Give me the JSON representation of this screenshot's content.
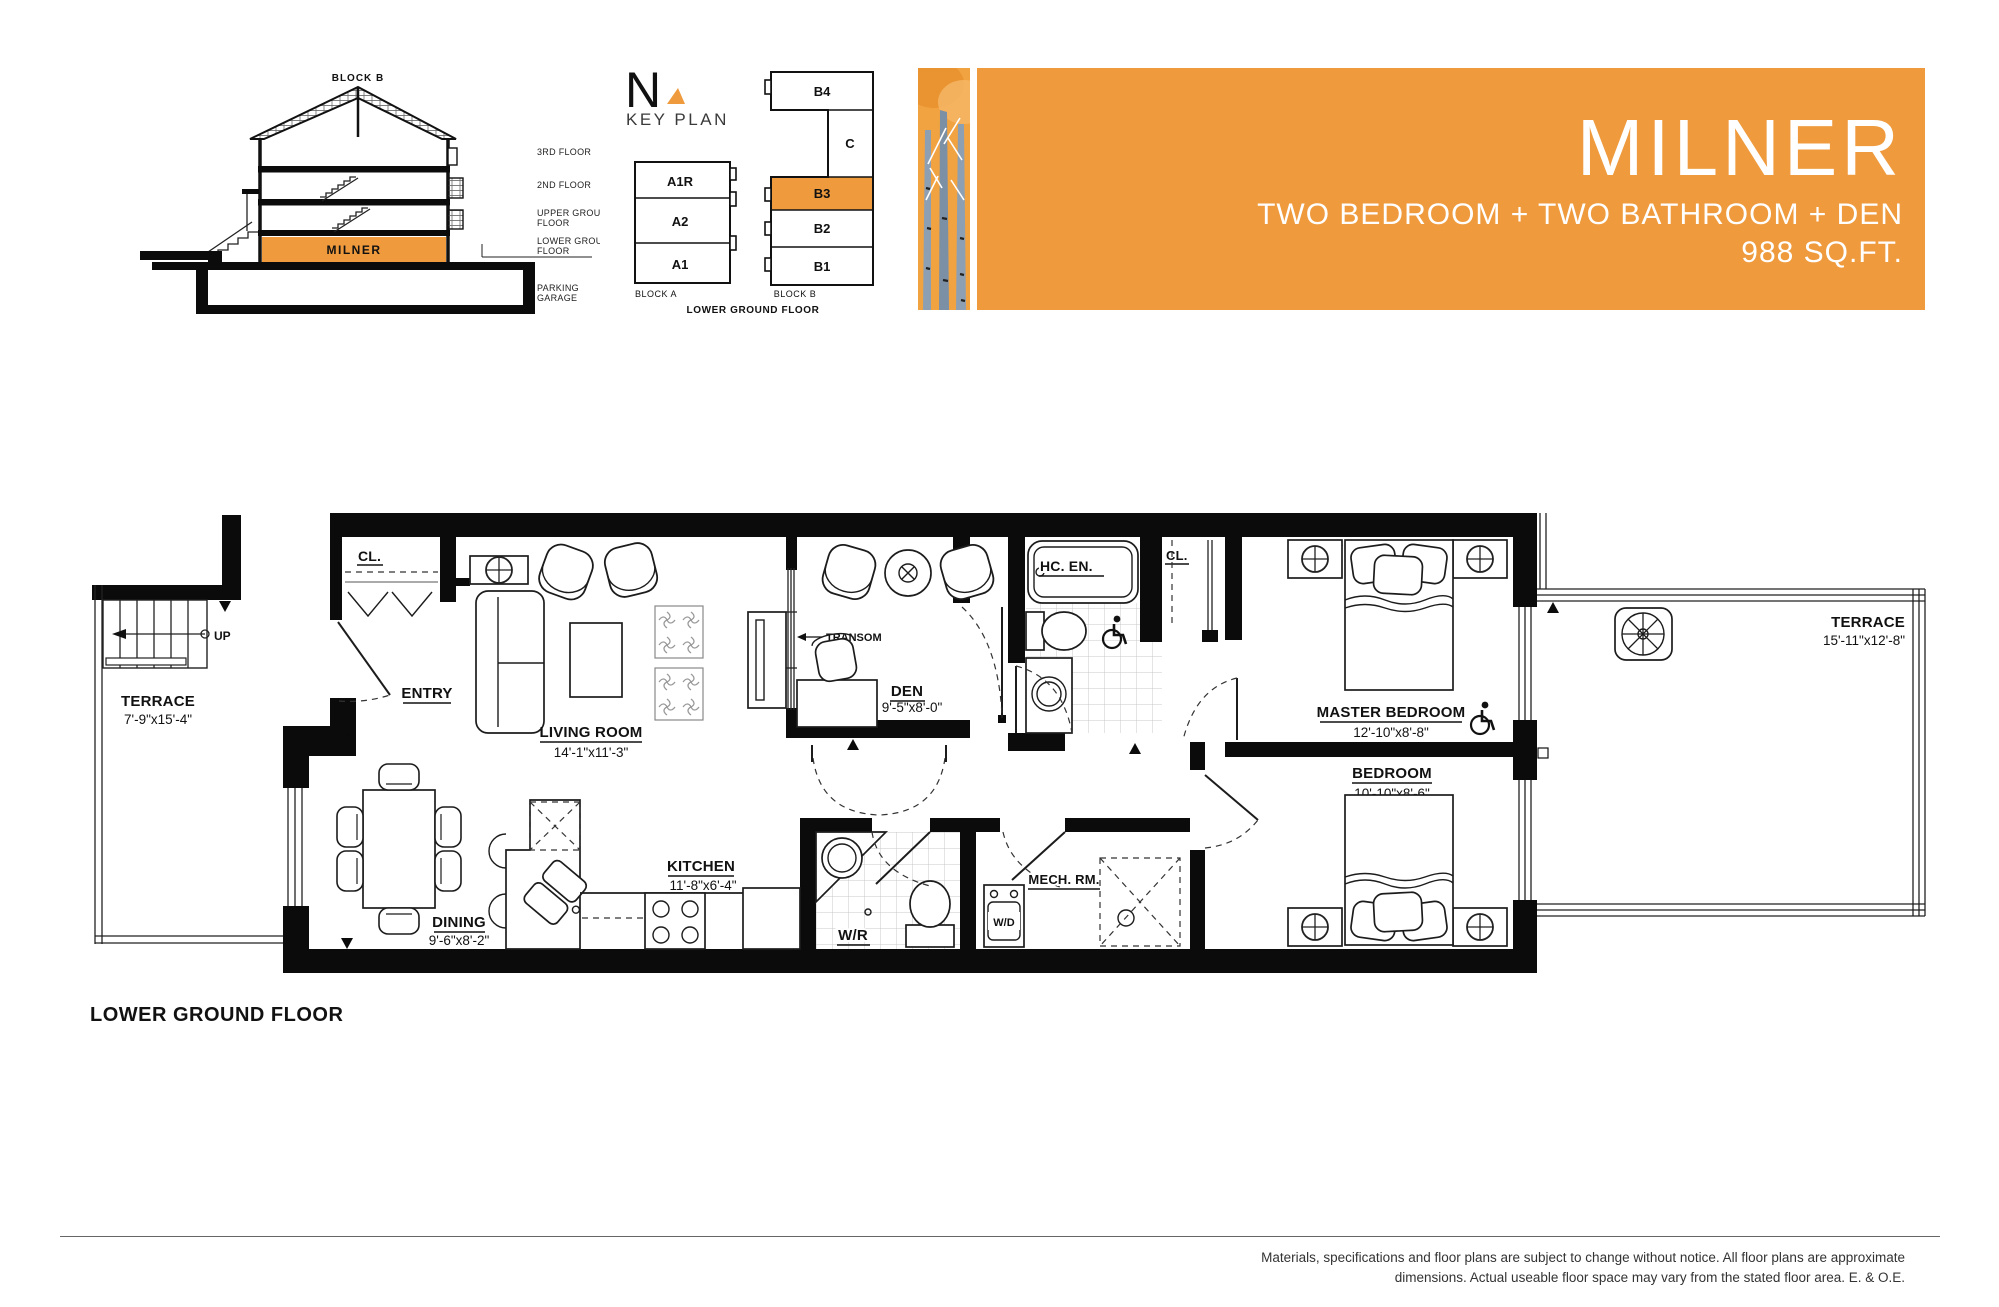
{
  "banner": {
    "title": "MILNER",
    "subtitle": "TWO BEDROOM + TWO BATHROOM + DEN",
    "area": "988 SQ.FT.",
    "accent_color": "#EF9A3D"
  },
  "section": {
    "block_label": "BLOCK B",
    "unit_label": "MILNER",
    "floor_3": "3RD FLOOR",
    "floor_2": "2ND FLOOR",
    "floor_ug1": "UPPER GROUND",
    "floor_ug2": "FLOOR",
    "floor_lg1": "LOWER GROUND",
    "floor_lg2": "FLOOR",
    "garage1": "PARKING",
    "garage2": "GARAGE"
  },
  "keyplan": {
    "north": "N",
    "title": "KEY PLAN",
    "units_a": [
      "A1R",
      "A2",
      "A1"
    ],
    "units_b": [
      "B4",
      "C",
      "B3",
      "B2",
      "B1"
    ],
    "highlighted_unit": "B3",
    "block_a_label": "BLOCK A",
    "block_b_label": "BLOCK B",
    "floor_label": "LOWER GROUND FLOOR"
  },
  "plan": {
    "floor_title": "LOWER GROUND FLOOR",
    "labels": {
      "terrace_left": "TERRACE",
      "terrace_left_dims": "7'-9\"x15'-4\"",
      "up": "UP",
      "closet": "CL.",
      "entry": "ENTRY",
      "living": "LIVING ROOM",
      "living_dims": "14'-1\"x11'-3\"",
      "transom": "TRANSOM",
      "den": "DEN",
      "den_dims": "9'-5\"x8'-0\"",
      "ensuite": "HC. EN.",
      "master": "MASTER BEDROOM",
      "master_dims": "12'-10\"x8'-8\"",
      "bedroom": "BEDROOM",
      "bedroom_dims": "10'-10\"x8'-6\"",
      "terrace_right": "TERRACE",
      "terrace_right_dims": "15'-11\"x12'-8\"",
      "dining": "DINING",
      "dining_dims": "9'-6\"x8'-2\"",
      "kitchen": "KITCHEN",
      "kitchen_dims": "11'-8\"x6'-4\"",
      "wr": "W/R",
      "mech": "MECH. RM.",
      "wd": "W/D"
    }
  },
  "footer": {
    "disclaimer_1": "Materials, specifications and floor plans are subject to change without notice. All floor plans are approximate",
    "disclaimer_2": "dimensions. Actual useable floor space may vary from the stated floor area. E. & O.E."
  }
}
